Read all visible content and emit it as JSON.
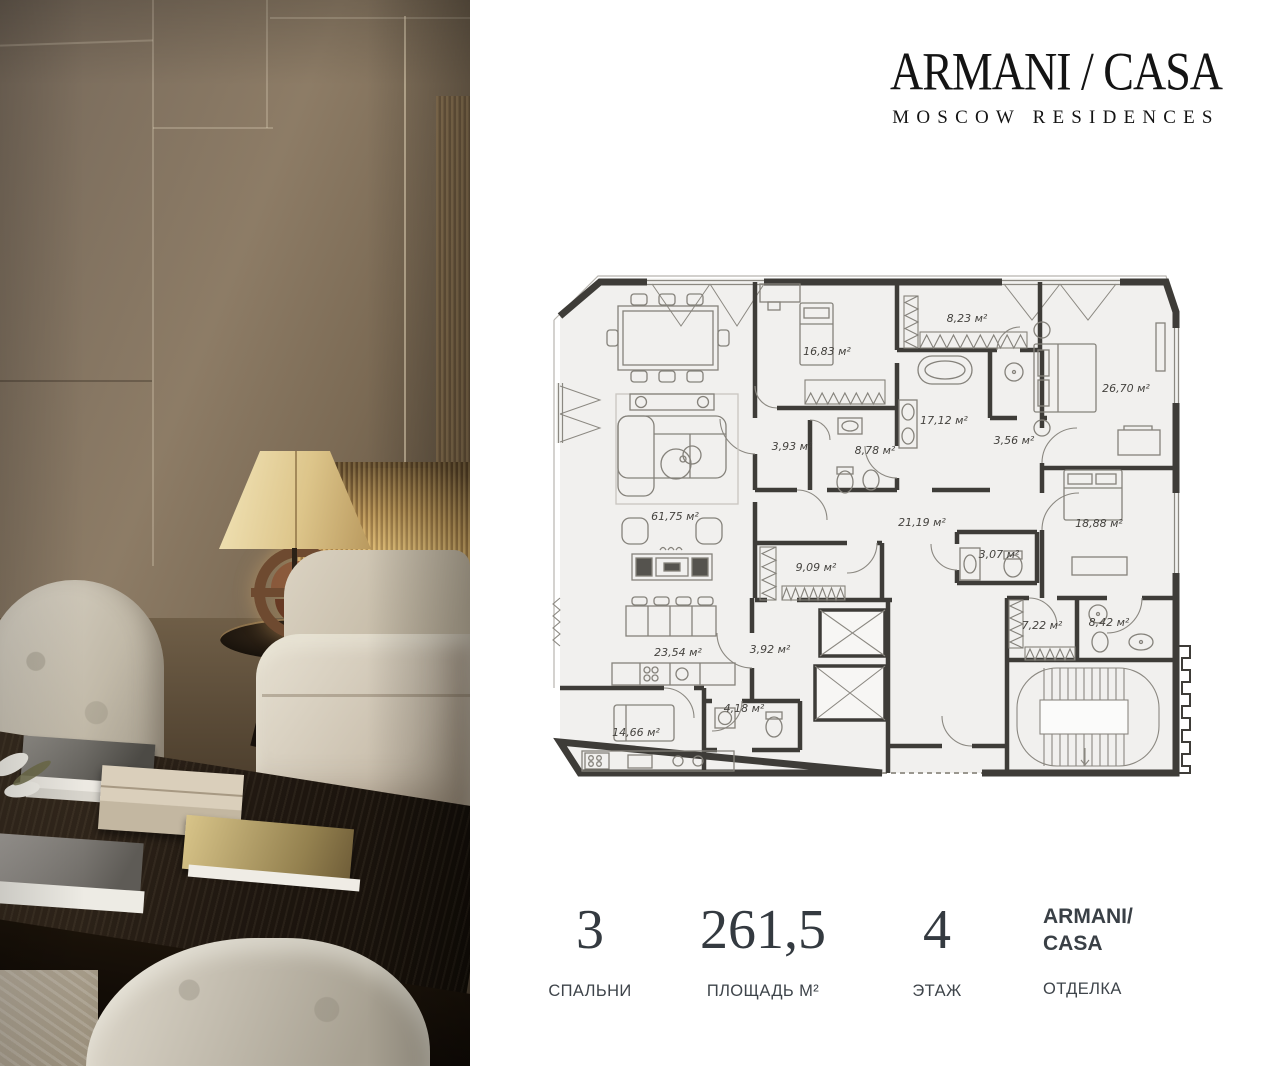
{
  "brand": {
    "name": "ARMANI / CASA",
    "subtitle": "MOSCOW RESIDENCES"
  },
  "floorplan": {
    "rooms": [
      {
        "name": "living-room",
        "area": "61,75 м²"
      },
      {
        "name": "bedroom-2",
        "area": "16,83 м²"
      },
      {
        "name": "wardrobe-hall",
        "area": "8,23 м²"
      },
      {
        "name": "master-bedroom",
        "area": "26,70 м²"
      },
      {
        "name": "hall-1",
        "area": "3,93 м²"
      },
      {
        "name": "bathroom-1",
        "area": "8,78 м²"
      },
      {
        "name": "master-bathroom",
        "area": "17,12 м²"
      },
      {
        "name": "hall-2",
        "area": "3,56 м²"
      },
      {
        "name": "corridor",
        "area": "21,19 м²"
      },
      {
        "name": "bedroom-3",
        "area": "18,88 м²"
      },
      {
        "name": "bathroom-2",
        "area": "3,07 м²"
      },
      {
        "name": "hallway",
        "area": "9,09 м²"
      },
      {
        "name": "wardrobe",
        "area": "7,22 м²"
      },
      {
        "name": "bathroom-3",
        "area": "8,42 м²"
      },
      {
        "name": "kitchen-dining",
        "area": "23,54 м²"
      },
      {
        "name": "hall-3",
        "area": "3,92 м²"
      },
      {
        "name": "laundry",
        "area": "4,18 м²"
      },
      {
        "name": "kitchen",
        "area": "14,66 м²"
      }
    ]
  },
  "stats": {
    "bedrooms": {
      "value": "3",
      "label": "СПАЛЬНИ"
    },
    "area": {
      "value": "261,5",
      "label": "ПЛОЩАДЬ М²"
    },
    "floor": {
      "value": "4",
      "label": "ЭТАЖ"
    },
    "finish": {
      "value_line1": "ARMANI/",
      "value_line2": "CASA",
      "label": "ОТДЕЛКА"
    }
  }
}
